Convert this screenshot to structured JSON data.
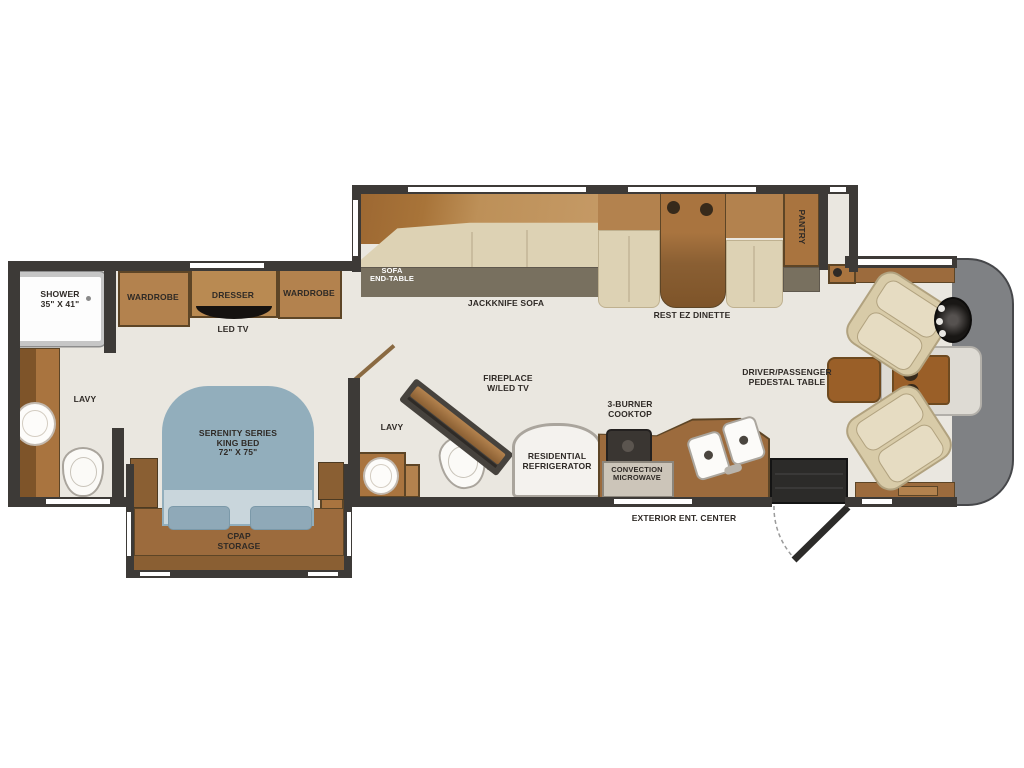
{
  "title": "Class A motorhome floor plan",
  "labels": {
    "shower": "SHOWER\n35\" X 41\"",
    "wardrobe_left": "WARDROBE",
    "dresser": "DRESSER",
    "wardrobe_right": "WARDROBE",
    "led_tv": "LED TV",
    "lavy_rear": "LAVY",
    "king_bed": "SERENITY SERIES\nKING BED\n72\" X 75\"",
    "cpap": "CPAP\nSTORAGE",
    "sofa_end_table": "SOFA\nEND-TABLE",
    "jackknife_sofa": "JACKKNIFE SOFA",
    "rest_ez_dinette": "REST EZ DINETTE",
    "pantry": "PANTRY",
    "lavy_mid": "LAVY",
    "fireplace": "FIREPLACE\nW/LED TV",
    "cooktop": "3-BURNER\nCOOKTOP",
    "refrigerator": "RESIDENTIAL\nREFRIGERATOR",
    "microwave": "CONVECTION\nMICROWAVE",
    "pedestal_table": "DRIVER/PASSENGER\nPEDESTAL TABLE",
    "exterior_ent": "EXTERIOR ENT. CENTER"
  },
  "colors": {
    "wall": "#3d3a37",
    "floor": "#eae7e0",
    "wood": "#a9743f",
    "wood_light": "#b3824e",
    "wood_dark": "#8a5f33",
    "cushion": "#ddd2b4",
    "bed_blue": "#92aebc",
    "bed_band": "#c9d6dc",
    "front_cap_gray": "#7f8184",
    "end_table_gray": "#78705f",
    "stairwell_black": "#2c2b29"
  }
}
